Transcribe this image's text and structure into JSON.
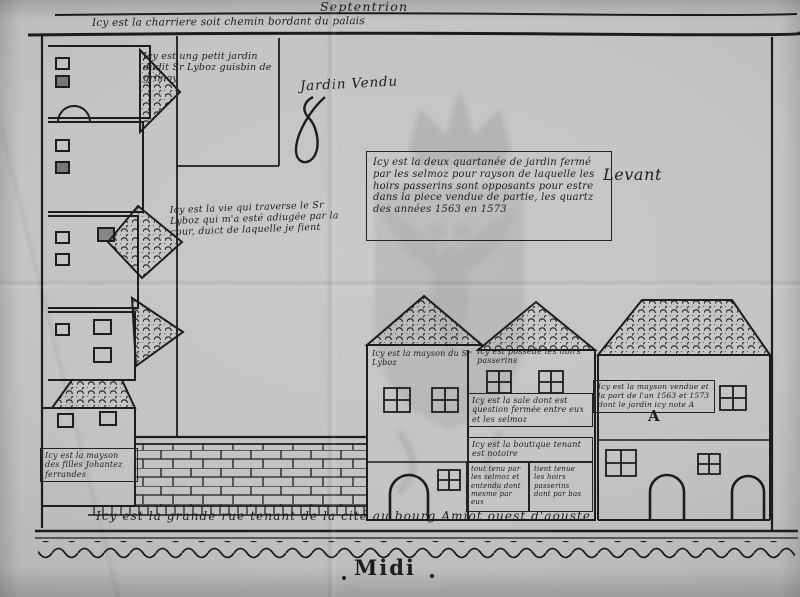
{
  "compass": {
    "north": "Septentrion",
    "east": "Levant",
    "south": "Midi"
  },
  "annotations": {
    "top_road": "Icy est la charriere soit chemin bordant du palais",
    "small_garden": "Icy est ung petit jardin dudit Sr Lyboz guisbin de grimoy",
    "garden_sold": "Jardin Vendu",
    "center_note": "Icy est la deux quartanée de jardin fermé par les selmoz pour rayson de laquelle les hoirs passerins sont opposants pour estre dans la piece vendue de partie, les quartz des années 1563 en 1573",
    "path_note": "Icy est la vie qui traverse le Sr Lyboz qui m'a esté adiugée par la cour, duict de laquelle je fient",
    "house_lyboz": "Icy est la mayson du Sr Lyboz",
    "house_passerins": "Icy est possédé les hoirs passerins",
    "sale_note": "Icy est la sale dont est question fermée entre eux et les selmoz",
    "boutique_note": "Icy est la boutique tenant est notoire",
    "cellar_left": "tout tenu par les selmoz et entendu dont mesme par eux",
    "cellar_right": "tient tenue les hoirs passerins dont par bas",
    "house_ferrandes": "Icy est la mayson des filles Johantez ferrandes",
    "house_sold": "Icy est la mayson vendue et la part de l'an 1563 et 1573 dont le jardin icy note A",
    "marker_a": "A",
    "bottom_road": "Icy est la grande rue tenant de la cité au bourg Amiot ouest d'aouste"
  },
  "colors": {
    "paper": "#c3c3c3",
    "ink": "#1d1d1d",
    "watermark": "#5f5f5f"
  }
}
